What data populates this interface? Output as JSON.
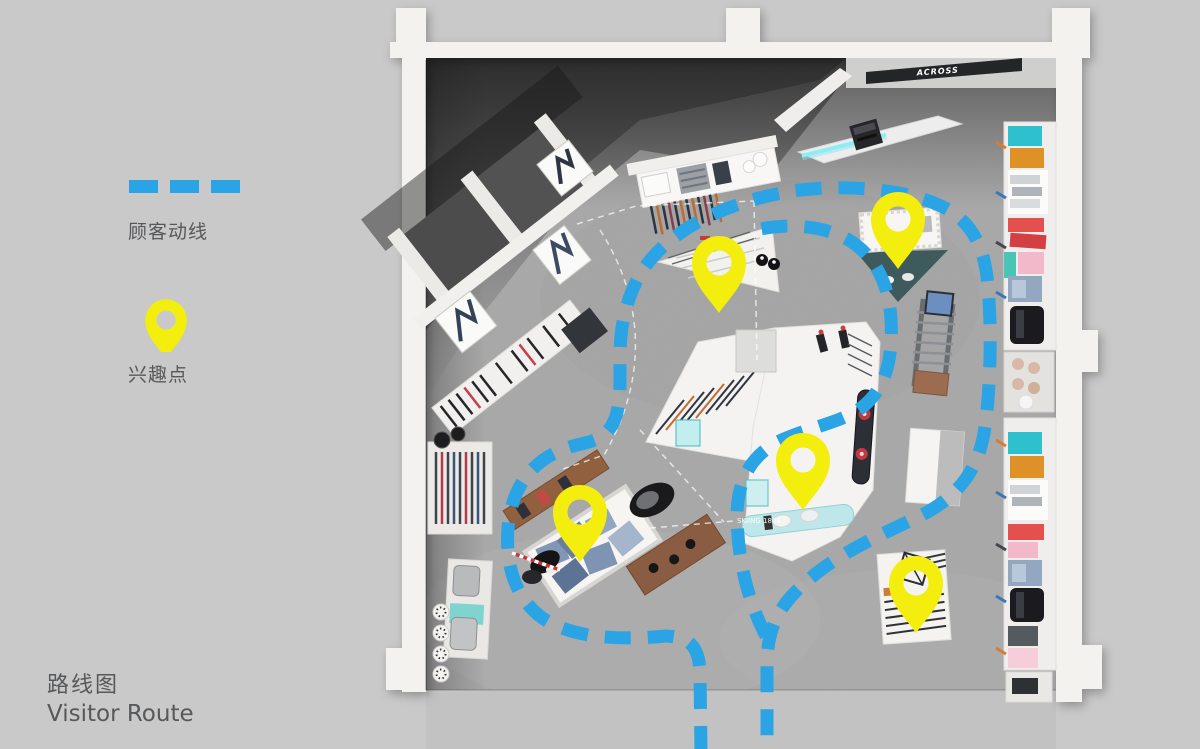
{
  "page": {
    "background": "#c9c9c9",
    "floor": "#a8a8a8",
    "outside": "#c2c2c2",
    "wall": "#f3f2ef"
  },
  "colors": {
    "route": "#2aa4e4",
    "poi": "#f3ee0e",
    "text": "#57585a"
  },
  "legend": {
    "route_label": "顾客动线",
    "poi_label": "兴趣点"
  },
  "title": {
    "zh": "路线图",
    "en": "Visitor Route"
  },
  "store": {
    "sign_text": "ACROSS",
    "zone_label": "SKIING 1804"
  },
  "route": {
    "width": 13,
    "dash": "26 17",
    "paths": {
      "outer": "M 701,752 L 700,672 C 699,648 691,637 666,636 C 625,640 578,639 547,621 C 516,602 505,566 508,528 C 511,491 529,464 559,451 C 583,440 603,446 614,421 C 625,396 616,357 623,322 C 630,286 645,260 671,240 C 702,215 745,199 792,191 C 843,184 902,188 941,206 C 969,219 983,243 987,277 C 992,322 991,384 985,427 C 979,471 957,498 918,517 C 880,535 837,554 806,582 C 783,602 769,622 767,658 L 767,752",
      "inner": "M 766,636 C 748,601 738,562 737,517 C 737,479 752,453 784,439 C 816,425 850,421 869,401 C 888,382 893,352 891,319 C 889,284 875,255 847,239 C 823,226 791,223 760,229"
    }
  },
  "pois": [
    {
      "x": 719,
      "y": 263
    },
    {
      "x": 898,
      "y": 219
    },
    {
      "x": 803,
      "y": 460
    },
    {
      "x": 580,
      "y": 512
    },
    {
      "x": 916,
      "y": 583
    }
  ]
}
